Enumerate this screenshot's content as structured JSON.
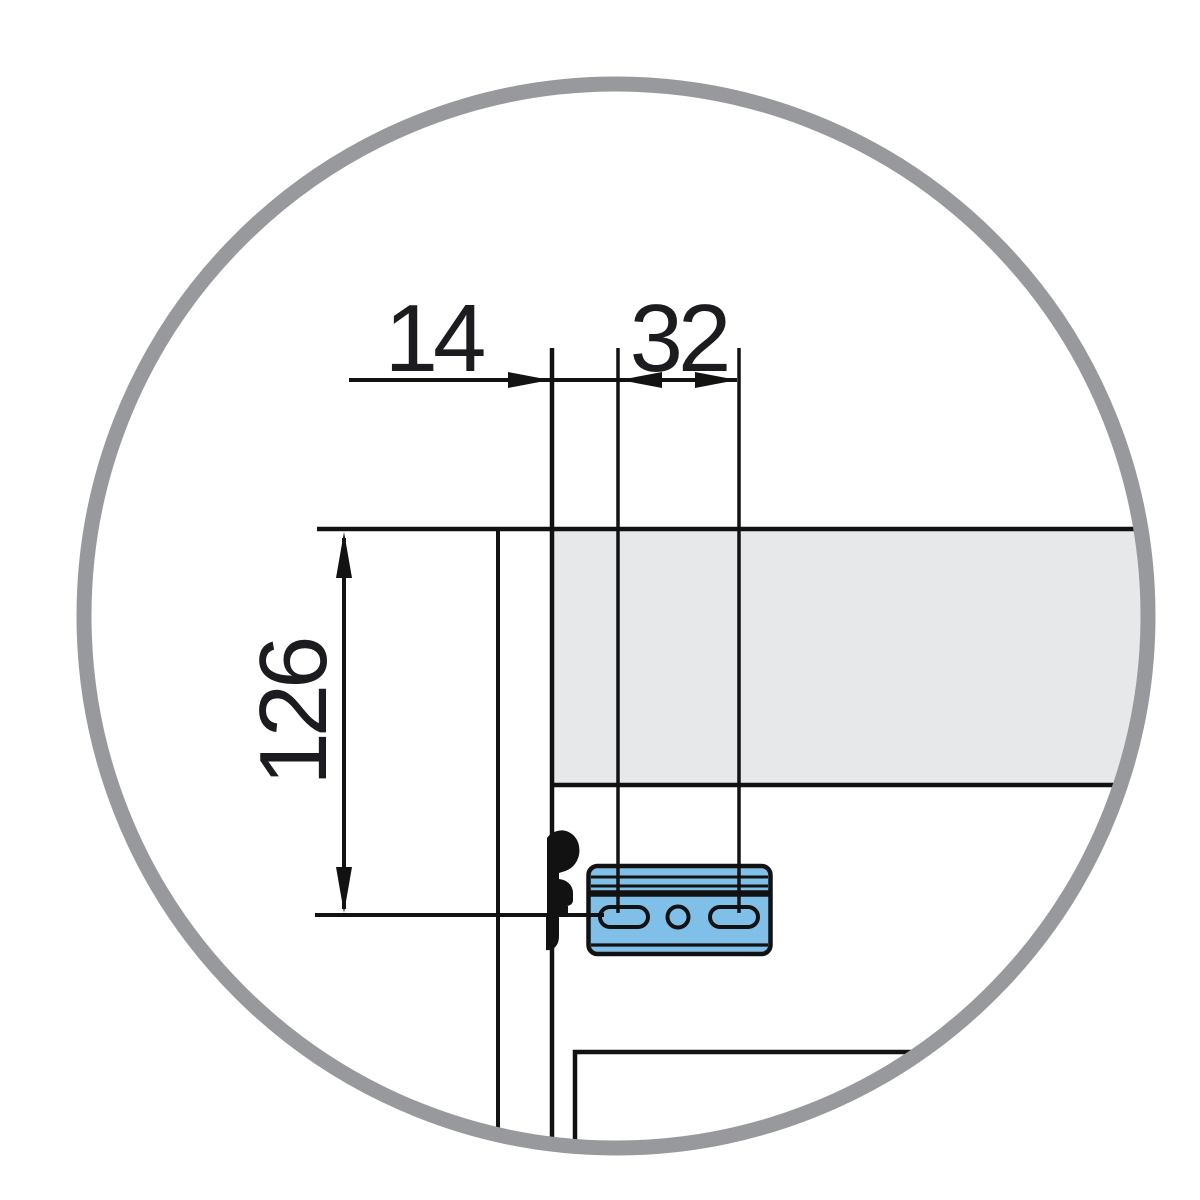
{
  "diagram": {
    "kind": "furniture-mounting-detail",
    "view": "magnified-circle-detail",
    "dimensions": {
      "panel_thickness": {
        "value": "14",
        "unit_hint": "mm",
        "orientation": "horizontal"
      },
      "hole_pitch": {
        "value": "32",
        "unit_hint": "mm",
        "orientation": "horizontal"
      },
      "mount_height": {
        "value": "126",
        "unit_hint": "mm",
        "orientation": "vertical"
      }
    },
    "parts": {
      "ring": "detail-lens-ring",
      "side_panel": "cabinet-side-panel",
      "rail": "drawer-rail-gray-panel",
      "bracket": "front-mounting-bracket-blue",
      "pin": "cam-pin-silhouette",
      "front_corner": "drawer-front-corner"
    },
    "colors": {
      "line": "#121212",
      "text": "#1b1b20",
      "ring": "#98999c",
      "panel": "#e7e8ea",
      "bracket": "#80c0e8",
      "background": "#ffffff"
    }
  }
}
